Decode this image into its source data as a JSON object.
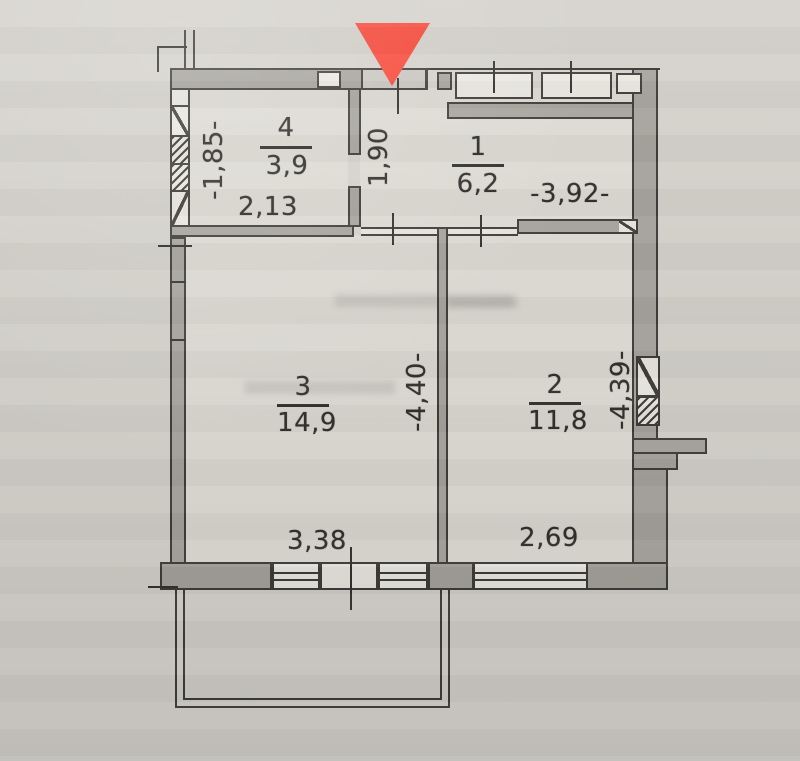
{
  "plan": {
    "type": "apartment-floor-plan",
    "entrance_marker": {
      "shape": "triangle-down",
      "color": "#f84434"
    },
    "colors": {
      "paper": "#d3d0ca",
      "room_fill": "#dcd9d2",
      "wall_fill": "#a5a29c",
      "line": "#3c3a36",
      "marker_red": "#f84434"
    },
    "rooms": {
      "r1": {
        "number": "1",
        "area": "6,2"
      },
      "r2": {
        "number": "2",
        "area": "11,8"
      },
      "r3": {
        "number": "3",
        "area": "14,9"
      },
      "r4": {
        "number": "4",
        "area": "3,9"
      }
    },
    "dimensions": {
      "r4_left_height": "-1,85-",
      "r4_bottom_width": "2,13",
      "hall_width": "1,90",
      "r1_width": "-3,92-",
      "r3_divider_height": "-4,40-",
      "r3_bottom_width": "3,38",
      "r2_right_height": "-4,39-",
      "r2_bottom_width": "2,69"
    }
  }
}
